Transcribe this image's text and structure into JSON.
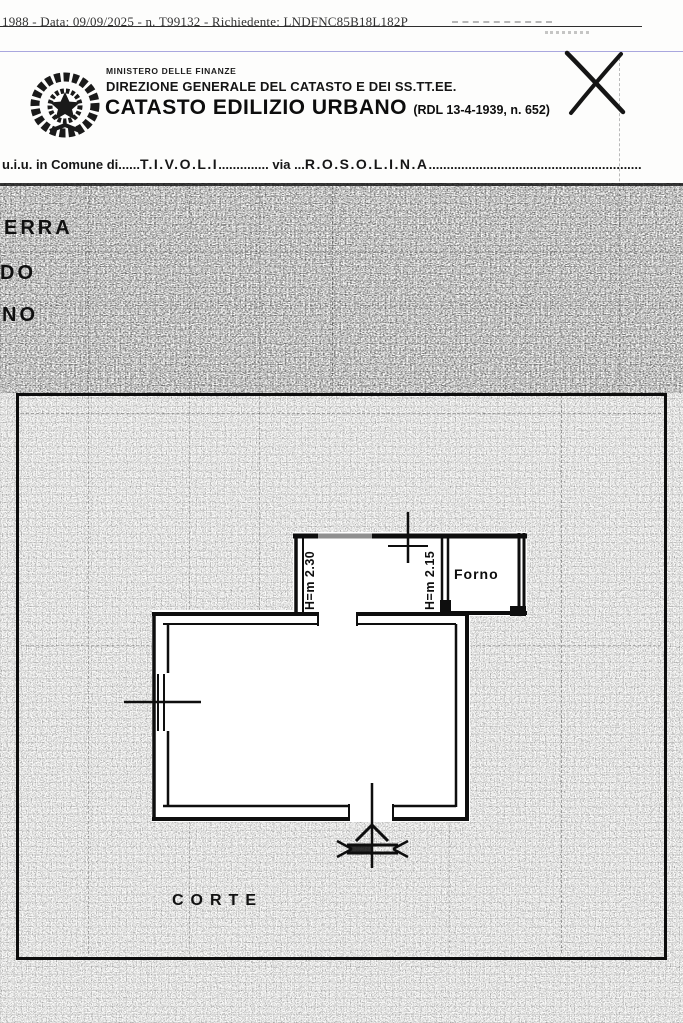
{
  "document": {
    "stamp_line": "1988 - Data: 09/09/2025 - n. T99132 - Richiedente: LNDFNC85B18L182P",
    "header": {
      "ministry": "MINISTERO DELLE FINANZE",
      "direction": "DIREZIONE GENERALE DEL CATASTO E DEI SS.TT.EE.",
      "title": "CATASTO EDILIZIO URBANO ",
      "title_ref": "(RDL 13-4-1939, n. 652)"
    },
    "location_line": {
      "prefix": "u.i.u. in Comune di",
      "dots1": "......",
      "comune": "T.I.V.O.L.I",
      "dots2": ".............. ",
      "via_label": "via",
      "dots3": " ...",
      "via": "R.O.S.O.L.I.N.A",
      "dots4": "..........................................................."
    },
    "margin_labels": [
      "ERRA",
      "DO",
      "NO"
    ],
    "plan": {
      "room_height_1": "H=m 2.30",
      "room_height_2": "H=m 2.15",
      "forno_label": "Forno",
      "corte_label": "CORTE"
    },
    "colors": {
      "ink": "#0e0e0e",
      "rule_blue": "#9a98d8",
      "wall_gray": "#8f8f8f"
    }
  }
}
